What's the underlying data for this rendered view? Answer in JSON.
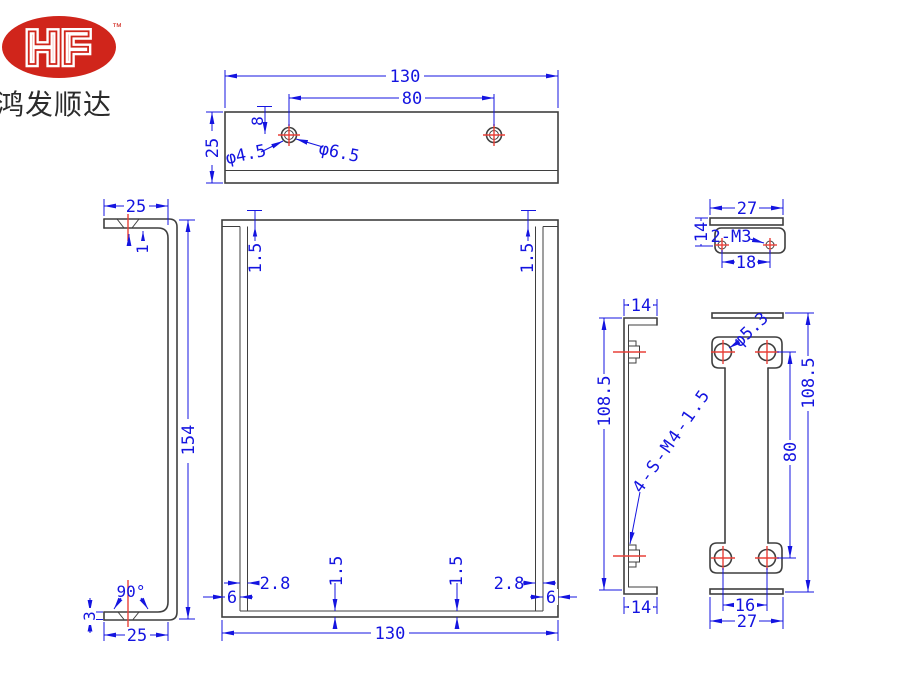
{
  "logo": {
    "monogram": "HF",
    "trademark": "™",
    "company_name": "鸿发顺达"
  },
  "colors": {
    "dimension_blue": "#1414e0",
    "geometry_gray": "#3f3f3f",
    "centerline_red": "#e84038",
    "logo_red": "#d0251b",
    "background": "#ffffff"
  },
  "views": {
    "top_view": {
      "overall_width": "130",
      "hole_spacing": "80",
      "depth": "25",
      "hole_offset": "8",
      "countersink_dia": "φ4.5",
      "hole_dia": "φ6.5"
    },
    "left_view": {
      "flange_width": "25",
      "thickness": "1",
      "height": "154",
      "angle": "90°",
      "bottom_thickness": "3",
      "bottom_flange_width": "25"
    },
    "front_view": {
      "top_thickness_left": "1.5",
      "top_thickness_right": "1.5",
      "inset_left": "2.8",
      "inset_right": "2.8",
      "bottom_thickness_left": "1.5",
      "bottom_thickness_right": "1.5",
      "flange_left": "6",
      "flange_right": "6",
      "overall_width": "130"
    },
    "side_view": {
      "top_flange": "14",
      "height": "108.5",
      "stud_callout": "4-S-M4-1.5",
      "bottom_flange": "14"
    },
    "small_view": {
      "width": "27",
      "thread_callout": "2-M3",
      "hole_spacing": "18",
      "depth": "14"
    },
    "back_view": {
      "hole_dia": "φ5.3",
      "height": "108.5",
      "hole_spacing_vertical": "80",
      "hole_spacing_horizontal": "16",
      "width": "27"
    }
  }
}
